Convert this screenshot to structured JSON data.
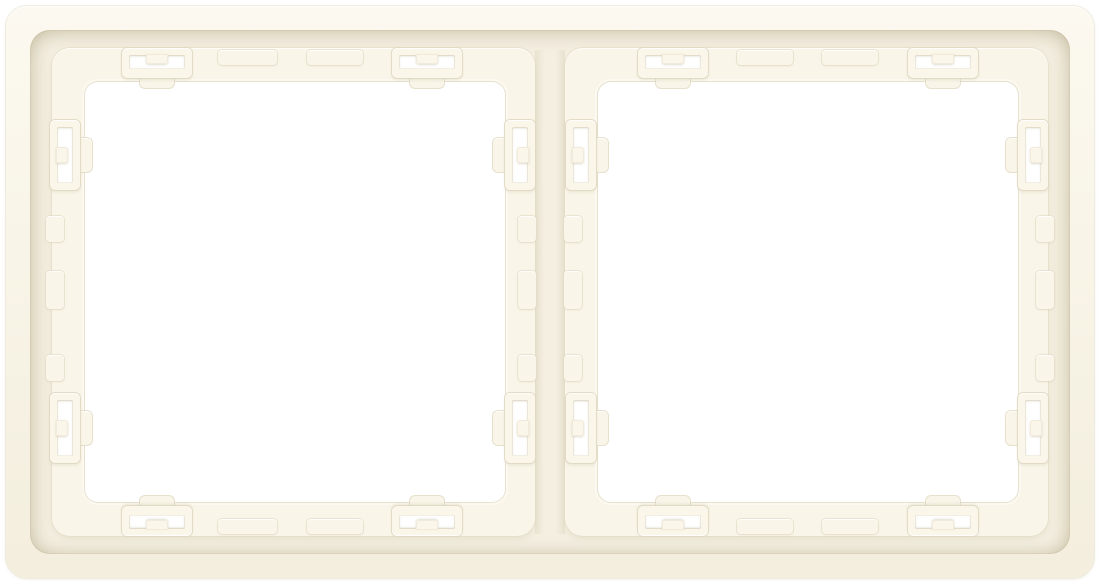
{
  "meta": {
    "alt": "Rear view of a cream-white two-gang electrical switch frame with two square module openings and snap-fit clips",
    "product_type": "2-gang installation frame, rear side",
    "openings_count": "2",
    "clips_per_opening": "8"
  },
  "colors": {
    "page-bg": "#ffffff",
    "frame-face": "#f8f4e7",
    "frame-face-light": "#fcf9f0",
    "frame-face-dark": "#f3eedd",
    "recess-floor": "#f4efe1",
    "rim-face": "#f9f5e8",
    "clip-face": "#faf6ea",
    "opening-white": "#ffffff",
    "step-shadow": "#ddd6c0",
    "outline-tan": "#e6dfca"
  }
}
